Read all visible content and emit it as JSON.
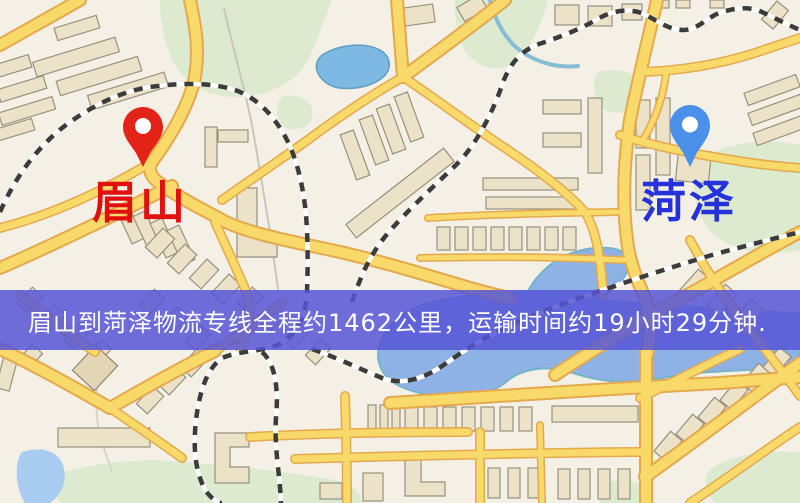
{
  "origin": {
    "label": "眉山",
    "marker_color": "#e42318",
    "label_color": "#e01010"
  },
  "destination": {
    "label": "菏泽",
    "marker_color": "#4b90e8",
    "label_color": "#2531da"
  },
  "banner": {
    "text": "眉山到菏泽物流专线全程约1462公里，运输时间约19小时29分钟.",
    "background": "#5655d6",
    "text_color": "#ffffff"
  },
  "route": {
    "distance_km": "1462",
    "duration": "19小时29分钟"
  },
  "map_colors": {
    "background": "#f4f0e6",
    "road_fill": "#f8d96a",
    "road_casing": "#e4a94e",
    "building": "#ebe2c8",
    "water": "#8fb2e6",
    "park": "#dcead0",
    "railway_dash": "#3b3b3b"
  }
}
